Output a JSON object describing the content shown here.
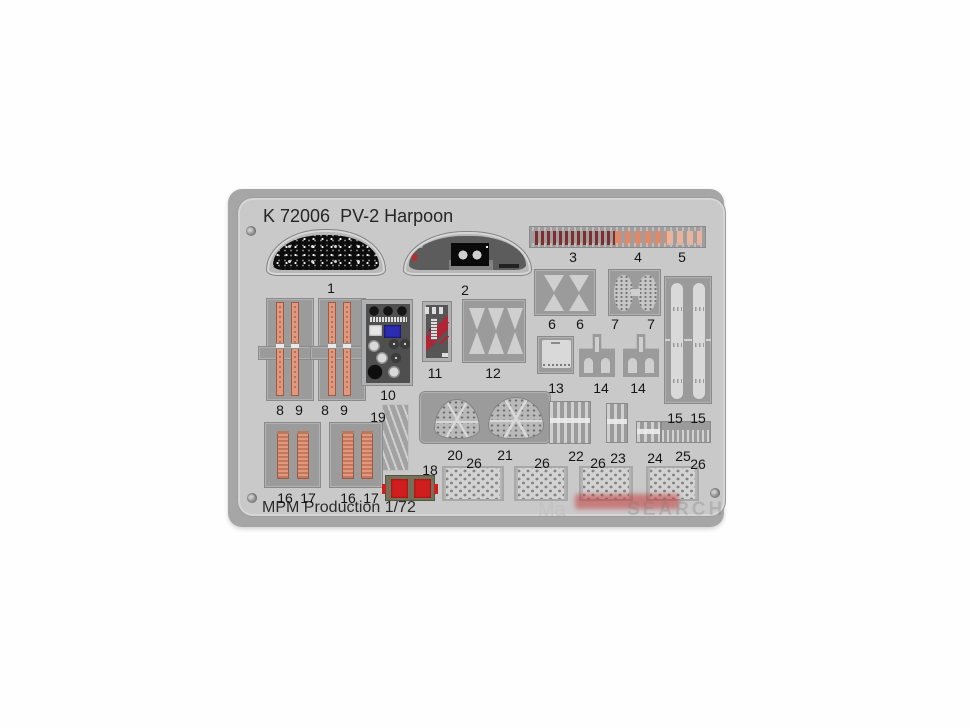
{
  "product": {
    "title": "K 72006  PV-2 Harpoon",
    "code": "K 72006",
    "subject": "PV-2 Harpoon",
    "manufacturer_line": "MPM Production 1/72"
  },
  "watermark": {
    "left": "Ma",
    "right": "SEARCH"
  },
  "colors": {
    "fret": "#c9c9c9",
    "part_backing": "#9b9b9b",
    "belt_salmon": "#e2987c",
    "strip_dark_red": "#7f2d2d",
    "strip_salmon": "#e08868",
    "strip_light_salmon": "#ecb39c",
    "red_part": "#d01d1d",
    "panel_black": "#0c0c0c"
  },
  "part_labels": [
    {
      "text": "1"
    },
    {
      "text": "2"
    },
    {
      "text": "3"
    },
    {
      "text": "4"
    },
    {
      "text": "5"
    },
    {
      "text": "6"
    },
    {
      "text": "6"
    },
    {
      "text": "7"
    },
    {
      "text": "7"
    },
    {
      "text": "8"
    },
    {
      "text": "9"
    },
    {
      "text": "8"
    },
    {
      "text": "9"
    },
    {
      "text": "10"
    },
    {
      "text": "11"
    },
    {
      "text": "12"
    },
    {
      "text": "13"
    },
    {
      "text": "14"
    },
    {
      "text": "14"
    },
    {
      "text": "15"
    },
    {
      "text": "15"
    },
    {
      "text": "16"
    },
    {
      "text": "17"
    },
    {
      "text": "16"
    },
    {
      "text": "17"
    },
    {
      "text": "18"
    },
    {
      "text": "19"
    },
    {
      "text": "20"
    },
    {
      "text": "21"
    },
    {
      "text": "22"
    },
    {
      "text": "23"
    },
    {
      "text": "24"
    },
    {
      "text": "25"
    },
    {
      "text": "26"
    },
    {
      "text": "26"
    },
    {
      "text": "26"
    },
    {
      "text": "26"
    }
  ]
}
